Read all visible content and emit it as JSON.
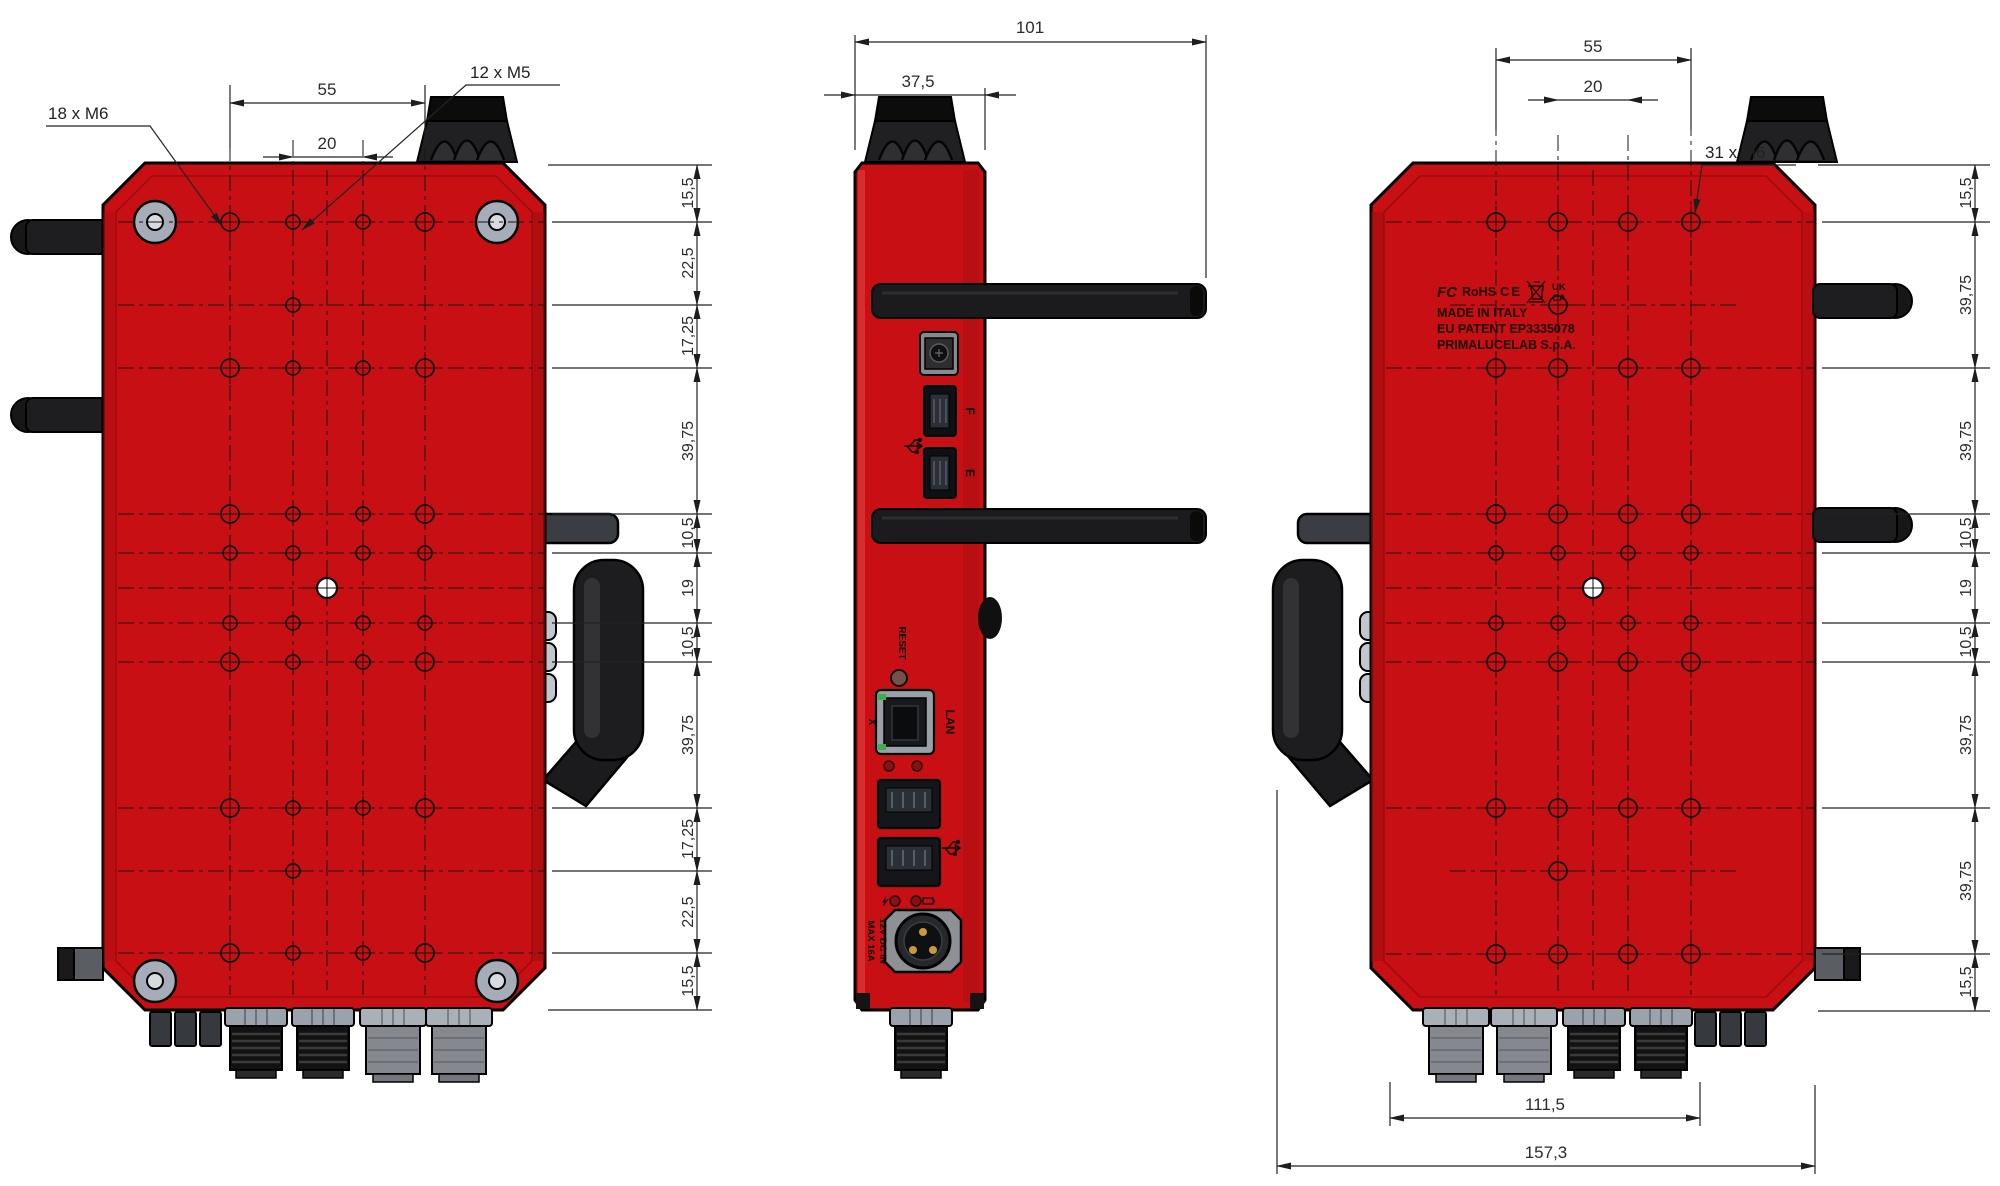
{
  "tv": {
    "leader_m6": "18 x M6",
    "leader_m5": "12 x M5",
    "w55": "55",
    "w20": "20",
    "stack": [
      "15,5",
      "22,5",
      "17,25",
      "39,75",
      "10,5",
      "19",
      "10,5",
      "39,75",
      "17,25",
      "22,5",
      "15,5"
    ]
  },
  "sv": {
    "w101": "101",
    "w375": "37,5",
    "labels": {
      "reset": "RESET",
      "lan": "LAN",
      "x": "X",
      "usb_f": "F",
      "usb_e": "E",
      "pwr1": "12V DC IN",
      "pwr2": "MAX 16A"
    }
  },
  "bv": {
    "leader_m6": "31 x M6",
    "w55": "55",
    "w20": "20",
    "w1115": "111,5",
    "w1573": "157,3",
    "stack": [
      "15,5",
      "39,75",
      "39,75",
      "10,5",
      "19",
      "10,5",
      "39,75",
      "39,75",
      "15,5"
    ],
    "marking": {
      "cert_fcc": "FC",
      "cert_rohs": "RoHS",
      "cert_ce": "CE",
      "cert_uk": "UK",
      "cert_ca": "CA",
      "line1": "MADE IN ITALY",
      "line2": "EU PATENT EP3335078",
      "line3": "PRIMALUCELAB S.p.A."
    }
  },
  "colors": {
    "body_red": "#c81014",
    "dark_part": "#1c1c1e",
    "metal_gray": "#a6adb8",
    "line": "#232323"
  }
}
